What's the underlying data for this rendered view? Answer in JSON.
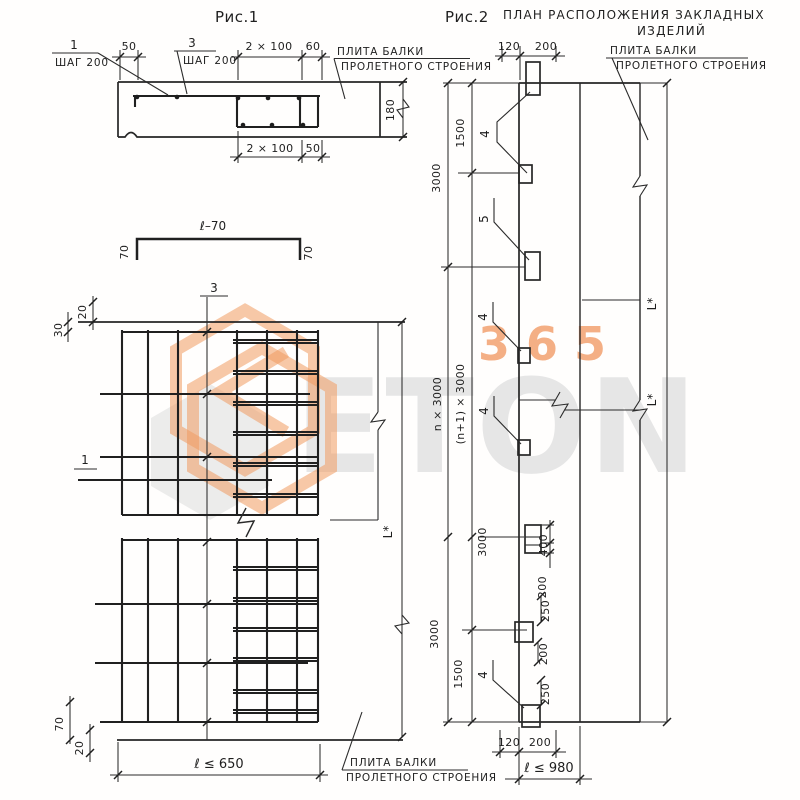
{
  "colors": {
    "line": "#2b2b2b",
    "watermark_orange": "#f09a60",
    "watermark_gray": "#e6e6e6",
    "background": "#fffefd"
  },
  "watermark": {
    "word": "ETON",
    "number": "365"
  },
  "fig1": {
    "title": "Рис.1",
    "sec": {
      "p1": "1",
      "p1s": "ШАГ 200",
      "d50": "50",
      "p3": "3",
      "p3s": "ШАГ 200",
      "d2x100": "2 × 100",
      "d60": "60",
      "plate1": "ПЛИТА БАЛКИ",
      "plate2": "ПРОЛЕТНОГО СТРОЕНИЯ",
      "d180": "180",
      "d2x100b": "2 × 100",
      "d50b": "50"
    },
    "ch": {
      "t": "ℓ–70",
      "l": "70",
      "r": "70"
    },
    "plan": {
      "d20t": "20",
      "d30t": "30",
      "p3": "3",
      "p1": "1",
      "L": "L*",
      "d70": "70",
      "d20b": "20",
      "len": "ℓ ≤ 650",
      "plate1": "ПЛИТА БАЛКИ",
      "plate2": "ПРОЛЕТНОГО СТРОЕНИЯ"
    }
  },
  "fig2": {
    "title": "Рис.2",
    "sub1": "ПЛАН РАСПОЛОЖЕНИЯ ЗАКЛАДНЫХ",
    "sub2": "ИЗДЕЛИЙ",
    "plate1": "ПЛИТА БАЛКИ",
    "plate2": "ПРОЛЕТНОГО СТРОЕНИЯ",
    "d120t": "120",
    "d200t": "200",
    "c3000a": "3000",
    "n3000": "n × 3000",
    "c3000b": "3000",
    "c1500a": "1500",
    "n13000": "(n+1) × 3000",
    "c3000c": "3000",
    "c1500b": "1500",
    "i4a": "4",
    "i5": "5",
    "i4b": "4",
    "i4c": "4",
    "i4d": "4",
    "d400": "400",
    "d200m": "200",
    "d250a": "250",
    "d200b": "200",
    "d250b": "250",
    "L1": "L*",
    "L2": "L*",
    "d120b": "120",
    "d200bb": "200",
    "len": "ℓ ≤ 980"
  }
}
